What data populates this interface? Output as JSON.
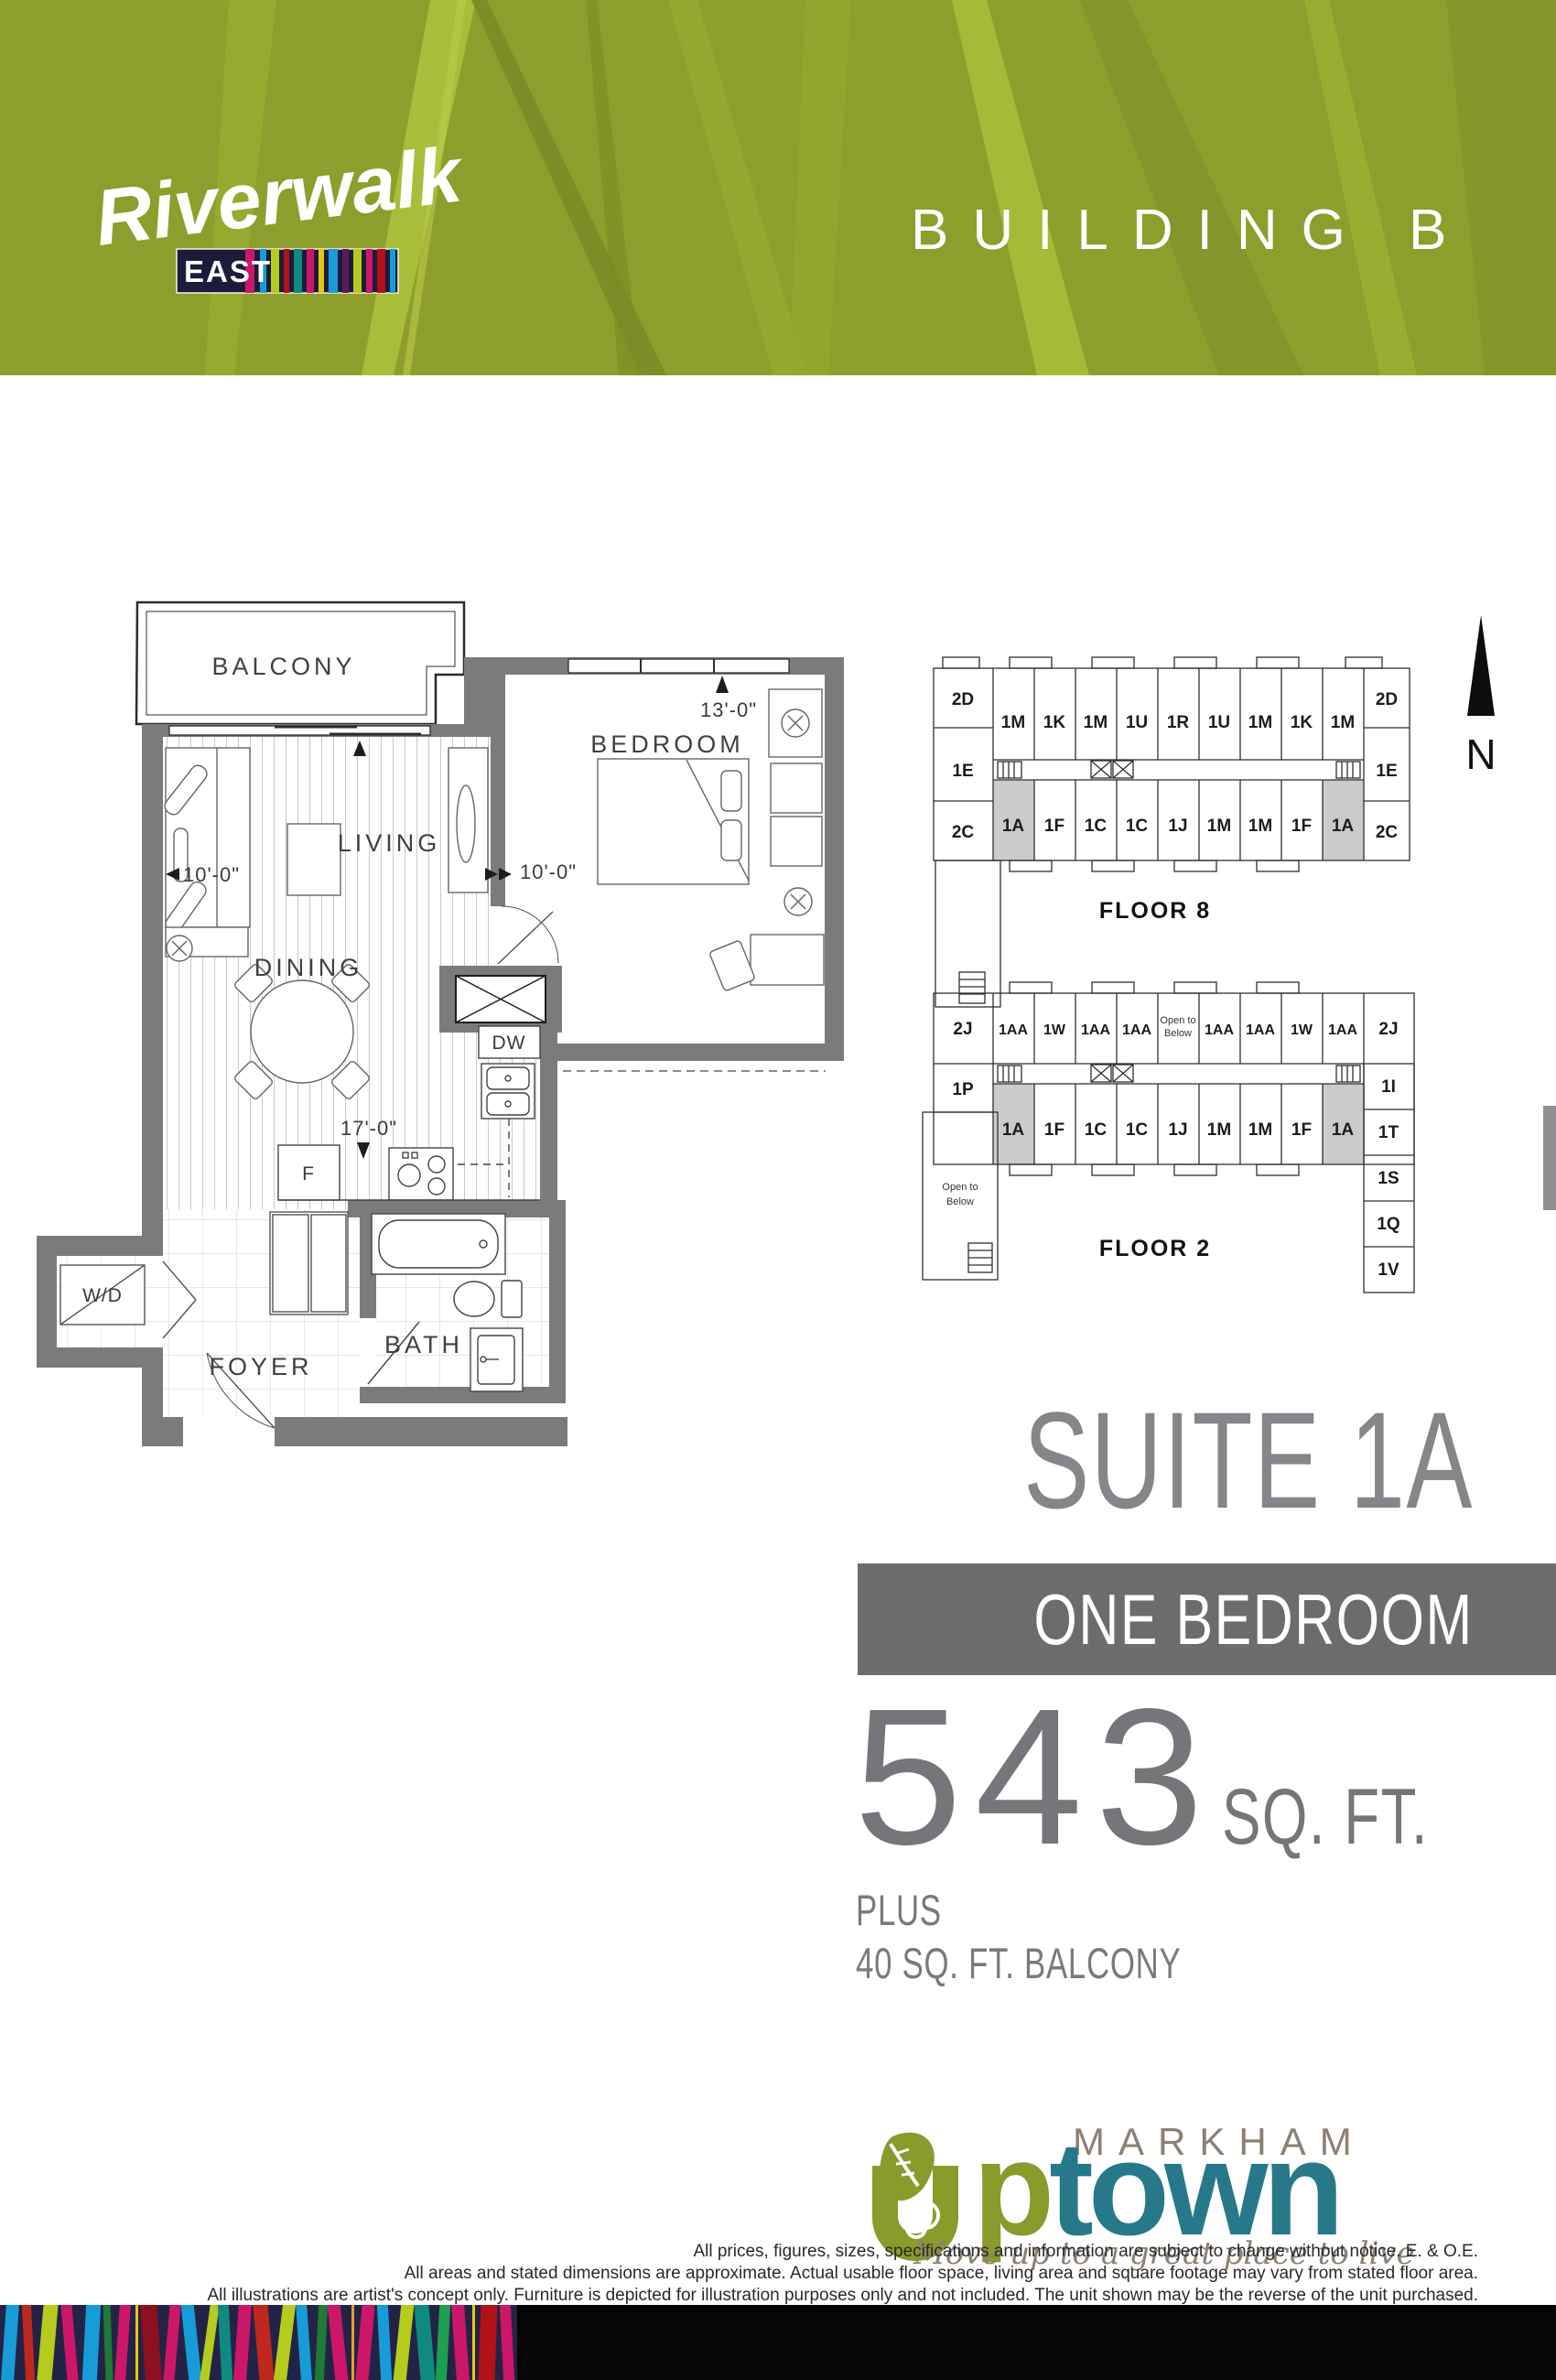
{
  "header": {
    "building_label": "BUILDING B",
    "brand": {
      "name": "Riverwalk",
      "sub": "EAST"
    }
  },
  "floorplan": {
    "rooms": {
      "balcony": "BALCONY",
      "bedroom": "BEDROOM",
      "living": "LIVING",
      "dining": "DINING",
      "bath": "BATH",
      "foyer": "FOYER"
    },
    "appliances": {
      "dishwasher": "DW",
      "fridge": "F",
      "washer_dryer": "W/D"
    },
    "dimensions": {
      "bedroom_width": "13'-0\"",
      "living_width": "10'-0\"",
      "bedroom_depth": "10'-0\"",
      "suite_length": "17'-0\""
    }
  },
  "keyplans": {
    "north_label": "N",
    "highlighted_unit": "1A",
    "floor8": {
      "title": "FLOOR 8",
      "left_column": [
        "2D",
        "1E",
        "2C"
      ],
      "right_column": [
        "2D",
        "1E",
        "2C"
      ],
      "top_row": [
        "1M",
        "1K",
        "1M",
        "1U",
        "1R",
        "1U",
        "1M",
        "1K",
        "1M"
      ],
      "bottom_row": [
        "1A",
        "1F",
        "1C",
        "1C",
        "1J",
        "1M",
        "1M",
        "1F",
        "1A"
      ]
    },
    "floor2": {
      "title": "FLOOR 2",
      "left_column": [
        "2J",
        "1P"
      ],
      "right_top": "2J",
      "top_row": [
        "1AA",
        "1W",
        "1AA",
        "1AA",
        "1AA",
        "1AA",
        "1W",
        "1AA"
      ],
      "open_to_below_l1": "Open to",
      "open_to_below_l2": "Below",
      "bottom_row": [
        "1A",
        "1F",
        "1C",
        "1C",
        "1J",
        "1M",
        "1M",
        "1F",
        "1A"
      ],
      "right_wing": [
        "1I",
        "1T",
        "1S",
        "1Q",
        "1V"
      ]
    }
  },
  "suite": {
    "title": "SUITE 1A",
    "type_label": "ONE BEDROOM",
    "area_value": "543",
    "area_unit": "SQ. FT.",
    "plus_label": "PLUS",
    "balcony_area": "40 SQ. FT. BALCONY"
  },
  "logo": {
    "city": "MARKHAM",
    "up_p": "p",
    "town": "town",
    "tagline": "Move up to a great place to live"
  },
  "disclaimer": {
    "line1": "All prices, figures, sizes, specifications and information are subject to change without notice. E. & O.E.",
    "line2": "All areas and stated dimensions are approximate. Actual usable floor space, living area and square footage may vary from stated floor area.",
    "line3": "All illustrations are artist's concept only. Furniture is depicted for illustration purposes only and not included. The unit shown may be the reverse of the unit purchased."
  },
  "colors": {
    "banner_green": "#8e9e2c",
    "band_gray": "#6c6c6f",
    "heading_gray": "#85858a",
    "wall_gray": "#7b7b7b",
    "highlight_gray": "#cbcbcb",
    "logo_olive": "#8a9a2b",
    "logo_teal": "#27798a",
    "logo_taupe": "#8d8073"
  }
}
